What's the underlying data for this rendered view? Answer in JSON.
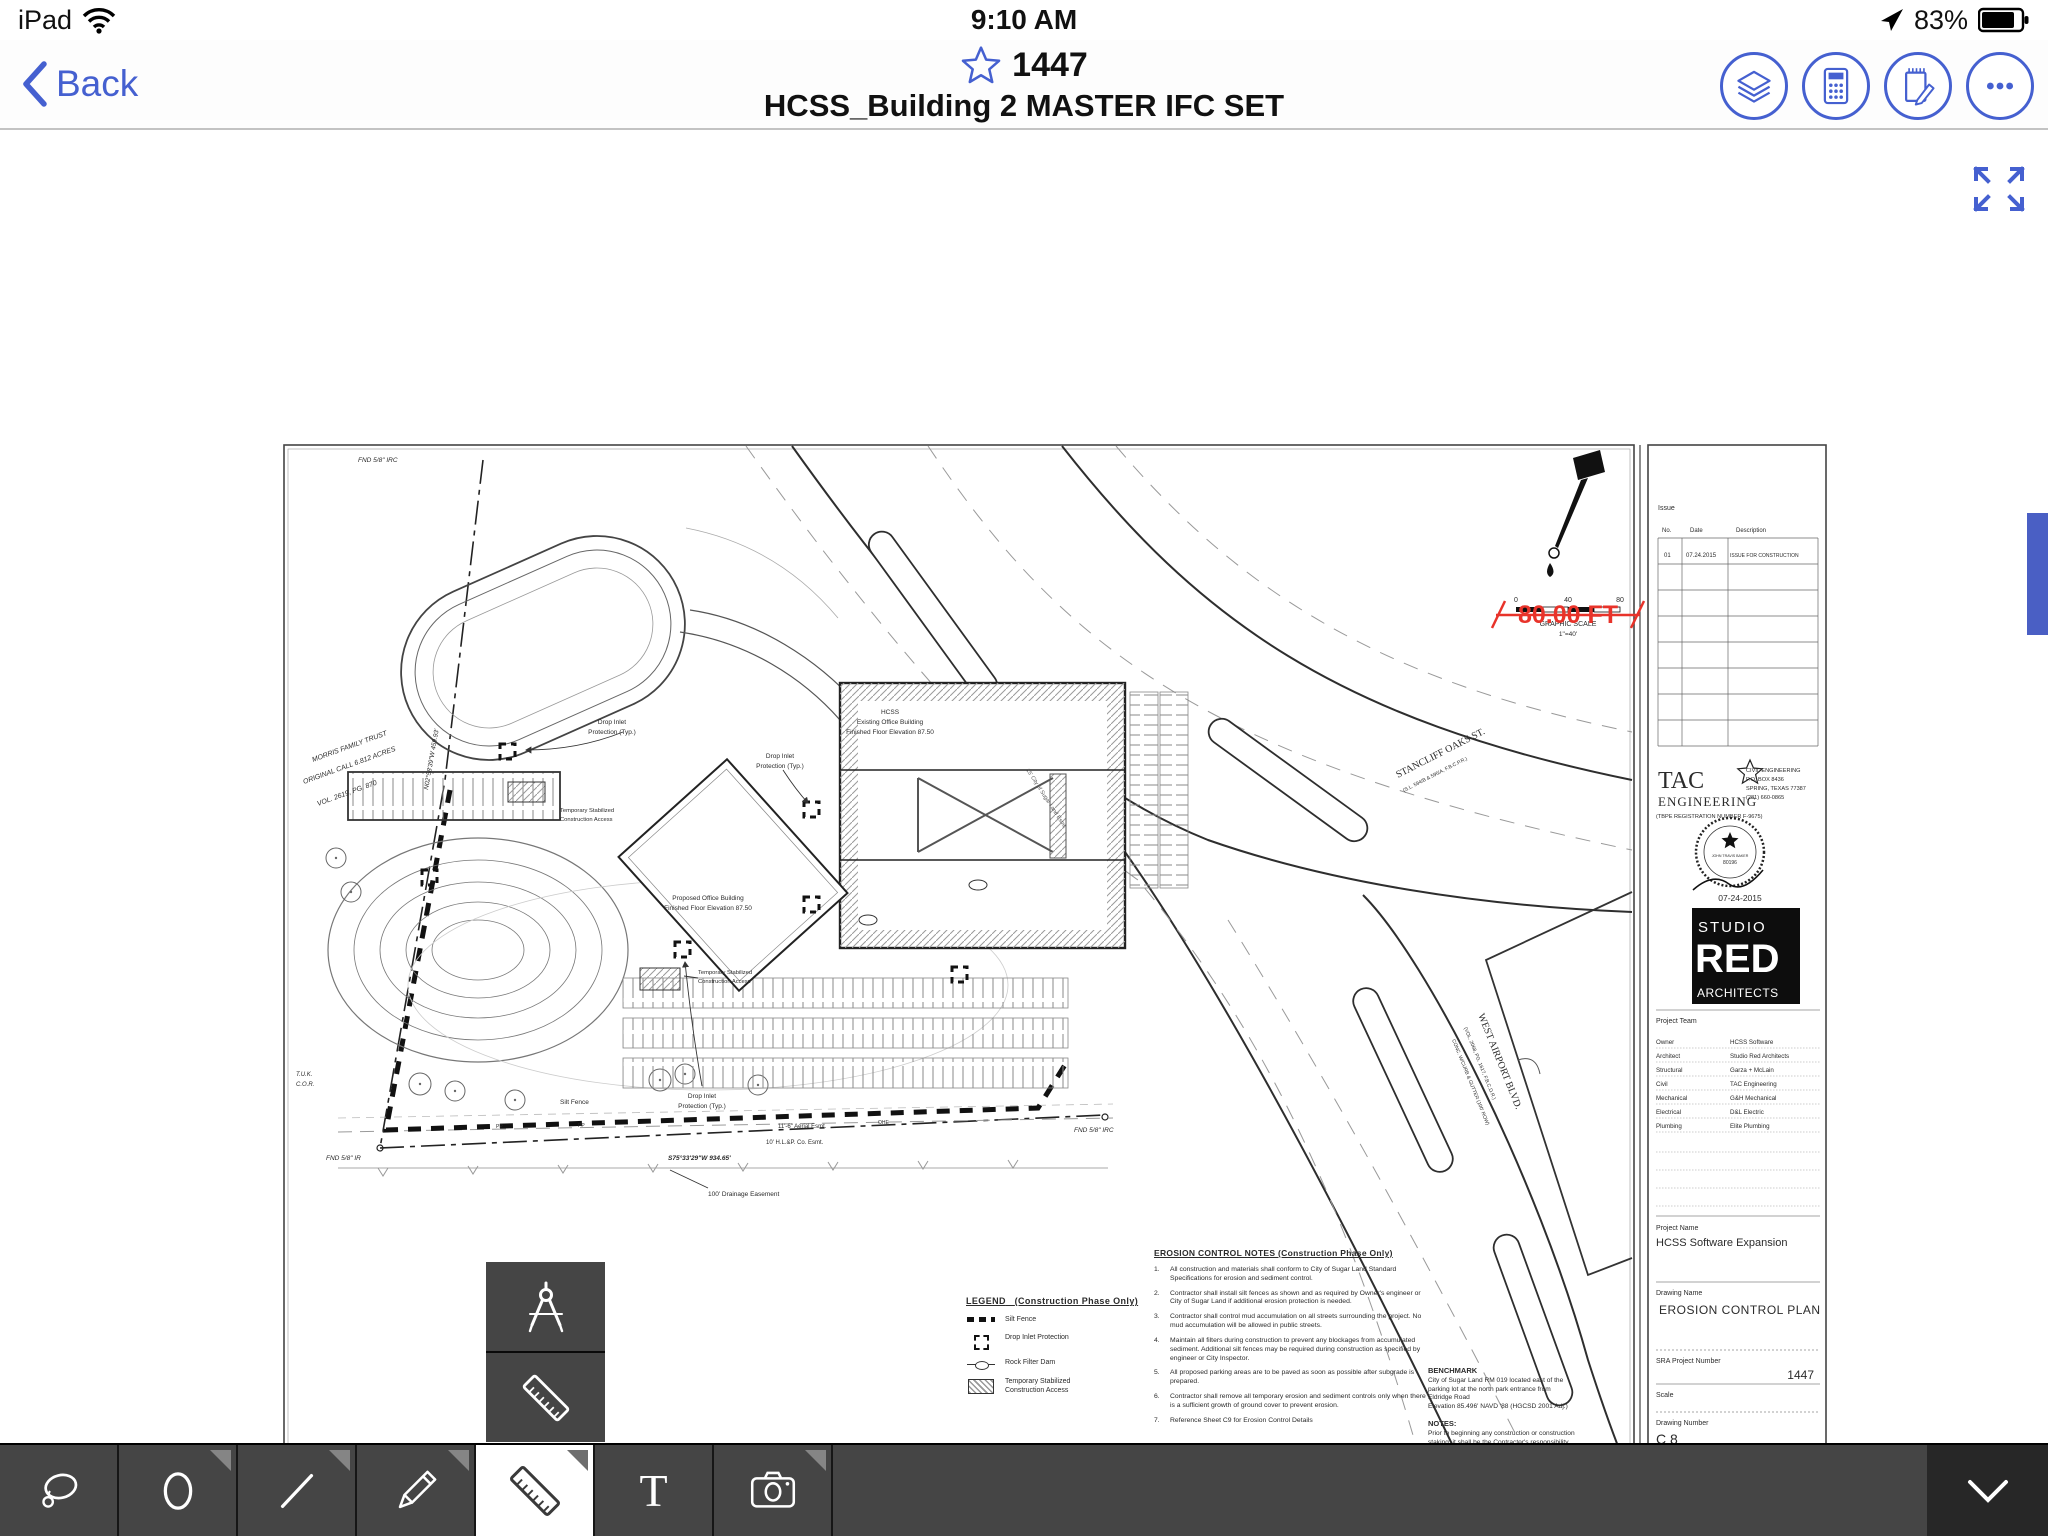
{
  "status_bar": {
    "device": "iPad",
    "time": "9:10 AM",
    "battery_percent": "83%"
  },
  "nav": {
    "back": "Back",
    "sheet_number": "1447",
    "doc_title": "HCSS_Building 2 MASTER IFC SET"
  },
  "viewer": {
    "measurement": "80.00 FT",
    "accent_blue": "#4560d0",
    "measure_red": "#e8332a"
  },
  "toolbar": {
    "active_tool": "ruler",
    "text_tool_glyph": "T"
  },
  "sheet": {
    "plan": {
      "fnd_nw": "FND 5/8\" IRC",
      "morris_1": "MORRIS FAMILY TRUST",
      "morris_2": "ORIGINAL CALL 6.812 ACRES",
      "morris_3": "VOL. 2619, PG. 870",
      "bearing_west": "N02°58'39\"W  459.93'",
      "tuk": "T.U.K.",
      "cor": "C.O.R.",
      "fnd_sw": "FND 5/8\" IR",
      "bearing_south": "S75°33'29\"W  934.65'",
      "fnd_se": "FND 5/8\" IRC",
      "silt_fence": "Silt Fence",
      "drainage_esmt": "100' Drainage Easement",
      "aerial_esmt": "11'-6\" Aerial Esmt.",
      "hlp_esmt": "10' H.L.&P. Co. Esmt.",
      "pp": "PP",
      "ohe": "OHE",
      "sugar_land_esmt": "15' City of Sugar Land Esmt.",
      "stancliff": "STANCLIFF OAKS ST.",
      "stancliff_sub": "(S.L. 594/B & 595/A, F.B.C.P.R.)",
      "west_airport": "WEST AIRPORT BLVD.",
      "wa_sub1": "(VOL. 2068, PG. 1617, F.B.C.D.R.)",
      "wa_sub2": "CONC. W/CURB & GUTTER  (100' ROW)",
      "hcss_1": "HCSS",
      "hcss_2": "Existing Office Building",
      "hcss_3": "Finished Floor Elevation 87.50",
      "prop_1": "Proposed Office Building",
      "prop_2": "Finished Floor Elevation 87.50",
      "di_1": "Drop Inlet",
      "di_2": "Protection (Typ.)",
      "ts_1": "Temporary Stabilized",
      "ts_2": "Construction Access"
    },
    "scale_bar": {
      "t0": "0",
      "t40": "40",
      "t80": "80",
      "title": "GRAPHIC SCALE",
      "ratio": "1\"=40'"
    },
    "legend": {
      "title": "LEGEND",
      "subtitle": "(Construction Phase Only)",
      "items": [
        "Silt Fence",
        "Drop Inlet Protection",
        "Rock Filter Dam",
        "Temporary Stabilized Construction Access"
      ]
    },
    "notes": {
      "title": "EROSION CONTROL NOTES  (Construction Phase Only)",
      "items": [
        {
          "n": "1.",
          "t": "All construction and materials shall conform to City of Sugar Land Standard Specifications for erosion and sediment control."
        },
        {
          "n": "2.",
          "t": "Contractor shall install silt fences as shown and as required by Owner's engineer or City of Sugar Land if additional erosion protection is needed."
        },
        {
          "n": "3.",
          "t": "Contractor shall control mud accumulation on all streets surrounding the project.  No mud accumulation will be allowed in public streets."
        },
        {
          "n": "4.",
          "t": "Maintain all filters during construction to prevent any blockages from accumulated sediment.  Additional silt fences may be required during construction as specified by engineer or City Inspector."
        },
        {
          "n": "5.",
          "t": "All proposed parking areas are to be paved as soon as possible after subgrade is prepared."
        },
        {
          "n": "6.",
          "t": "Contractor shall remove all temporary erosion and sediment controls only when there is a sufficient growth of ground cover to prevent erosion."
        },
        {
          "n": "7.",
          "t": "Reference Sheet C9  for Erosion Control Details"
        }
      ]
    },
    "benchmark": {
      "title": "BENCHMARK",
      "b": [
        "City of Sugar Land RM 019 located east of the",
        "parking lot at the north park entrance from",
        "Eldridge Road",
        "Elevation 85.496' NAVD '88 (HGCSD 2001 Adj.)"
      ],
      "notes_title": "NOTES:",
      "n": [
        "Prior to beginning any construction or construction",
        "staking, it shall be the Contractor's responsibility",
        "to contact the Civil Engineer to insure that all",
        "parties are in possession of the most current set",
        "of construction documents."
      ]
    },
    "title_block": {
      "issue_label": "Issue",
      "col_no": "No.",
      "col_date": "Date",
      "col_desc": "Description",
      "row_no": "01",
      "row_date": "07.24.2015",
      "row_desc": "ISSUE FOR CONSTRUCTION",
      "tac_1": "TAC",
      "tac_2": "ENGINEERING",
      "tac_reg": "(TBPE REGISTRATION NUMBER F-9675)",
      "tac_info": [
        "CIVIL ENGINEERING",
        "P.O. BOX 8436",
        "SPRING, TEXAS 77387",
        "(281) 660-0865"
      ],
      "seal_name": "JOHN TRAVIS BAKER",
      "seal_number": "80196",
      "seal_date": "07-24-2015",
      "studio_1": "STUDIO",
      "studio_2": "RED",
      "studio_3": "ARCHITECTS",
      "team_label": "Project Team",
      "team": [
        [
          "Owner",
          "HCSS Software"
        ],
        [
          "Architect",
          "Studio Red Architects"
        ],
        [
          "Structural",
          "Garza + McLain"
        ],
        [
          "Civil",
          "TAC Engineering"
        ],
        [
          "Mechanical",
          "G&H Mechanical"
        ],
        [
          "Electrical",
          "D&L Electric"
        ],
        [
          "Plumbing",
          "Elite Plumbing"
        ]
      ],
      "project_name_label": "Project Name",
      "project_name": "HCSS Software Expansion",
      "drawing_name_label": "Drawing Name",
      "drawing_name": "EROSION CONTROL PLAN",
      "sra_label": "SRA Project Number",
      "sra_value": "1447",
      "scale_label": "Scale",
      "number_label": "Drawing Number",
      "number_value": "C 8",
      "footer_1": "1320 McGowen, Houston, Texas 77004",
      "footer_2": "www.studioredarchitects.com 713.622.6333"
    }
  }
}
